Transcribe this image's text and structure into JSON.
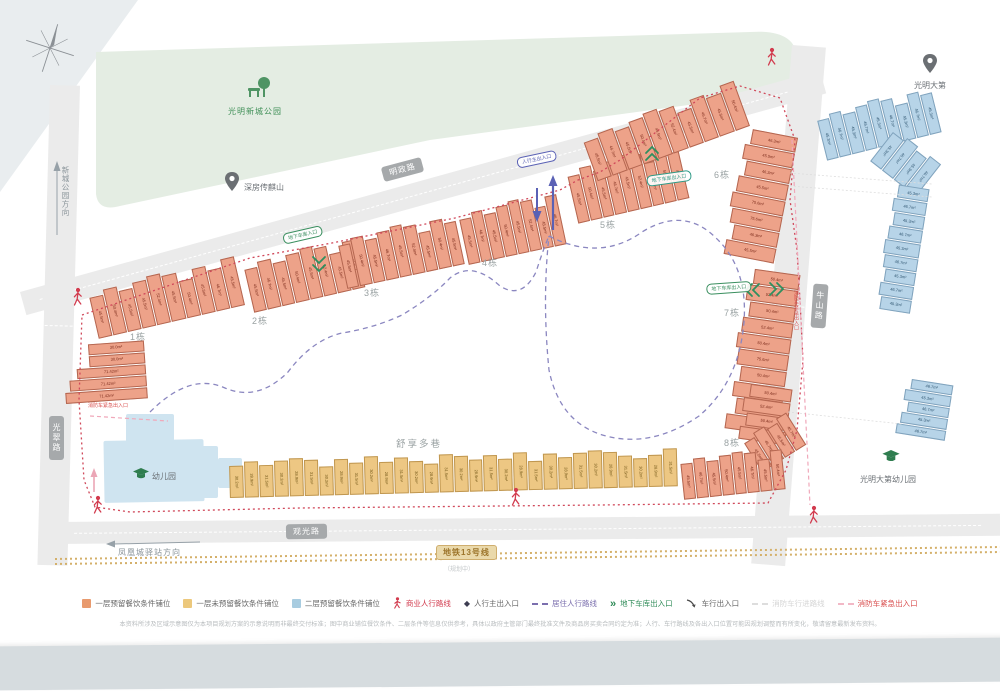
{
  "site_plan": {
    "park": {
      "label": "光明新城公园",
      "icon": "tree-bench-icon",
      "color": "#e4ede3"
    },
    "landmarks": [
      {
        "id": "chuanqishan",
        "label": "深房传麒山",
        "icon": "location-pin-icon"
      },
      {
        "id": "guangmingdadi",
        "label": "光明大第",
        "icon": "location-pin-icon"
      },
      {
        "id": "kindergarten",
        "label": "幼儿园",
        "icon": "graduation-cap-icon"
      },
      {
        "id": "gmdd-kindergarten",
        "label": "光明大第幼儿园",
        "icon": "graduation-cap-icon"
      }
    ],
    "roads": {
      "top": "明政路",
      "bottom": "观光路",
      "left": "光翠路",
      "right": "牛山路"
    },
    "metro": {
      "label": "地铁13号线",
      "note": "（规划中）",
      "color": "#cfae6e"
    },
    "directions": [
      {
        "label": "新城公园方向"
      },
      {
        "label": "凤凰城驿站方向"
      }
    ],
    "entrances": [
      {
        "id": "garage-in-west",
        "label": "地下车库入口",
        "color": "#3a8f5f"
      },
      {
        "id": "pedestrian-main",
        "label": "人行主出入口",
        "color": "#5a61b5"
      },
      {
        "id": "garage-north",
        "label": "地下车库出入口",
        "color": "#2f9a86"
      },
      {
        "id": "garage-east",
        "label": "地下车库出入口",
        "color": "#3a8f5f"
      },
      {
        "id": "fire-west",
        "label": "消防车紧急出入口",
        "color": "#d94f4f"
      },
      {
        "id": "fire-east",
        "label": "消防车紧急出入口",
        "color": "#d94f4f"
      }
    ],
    "area_note": "舒享多巷",
    "building_labels": [
      "1栋",
      "2栋",
      "3栋",
      "4栋",
      "5栋",
      "6栋",
      "7栋",
      "8栋"
    ],
    "clusters": {
      "b1row": {
        "units": [
          "45.5m²",
          "50.4m²",
          "45.5m²",
          "45.5m²",
          "52.4m²",
          "45.5m²",
          "50.4m²",
          "45.5m²",
          "46.7m²",
          "45.5m²"
        ]
      },
      "b1stack": {
        "units": [
          "30.0m²",
          "30.0m²",
          "71.42m²",
          "71.42m²",
          "71.42m²"
        ]
      },
      "b2row": {
        "units": [
          "45.5m²",
          "46.7m²",
          "45.5m²",
          "50.4m²",
          "45.5m²",
          "52.4m²",
          "45.5m²",
          "46.7m²"
        ]
      },
      "b3row": {
        "units": [
          "45.5m²",
          "50.4m²",
          "45.5m²",
          "46.7m²",
          "45.5m²",
          "52.4m²",
          "45.5m²",
          "50.4m²",
          "45.5m²"
        ]
      },
      "b4row": {
        "units": [
          "45.5m²",
          "46.7m²",
          "45.5m²",
          "50.4m²",
          "45.5m²",
          "52.4m²",
          "45.5m²",
          "46.7m²"
        ]
      },
      "b5row": {
        "units": [
          "45.5m²",
          "50.4m²",
          "45.5m²",
          "46.7m²",
          "45.5m²",
          "52.4m²",
          "45.5m²",
          "50.4m²",
          "45.5m²"
        ]
      },
      "b6rowA": {
        "units": [
          "45.5m²",
          "46.7m²",
          "45.5m²",
          "50.4m²",
          "45.5m²",
          "52.4m²",
          "45.5m²",
          "46.7m²",
          "45.5m²",
          "50.4m²"
        ]
      },
      "b6col": {
        "units": [
          "46.3m²",
          "45.5m²",
          "46.3m²",
          "45.5m²",
          "75.6m²",
          "75.6m²",
          "46.3m²",
          "45.5m²"
        ]
      },
      "b7col": {
        "units": [
          "50.4m²",
          "52.4m²",
          "50.4m²",
          "52.4m²",
          "50.4m²",
          "75.6m²",
          "50.4m²",
          "52.4m²",
          "50.4m²",
          "52.4m²"
        ]
      },
      "b8col": {
        "units": [
          "50.4m²",
          "52.4m²",
          "50.4m²",
          "52.4m²"
        ]
      },
      "b8mid": {
        "units": [
          "45.5m²",
          "46.7m²",
          "45.5m²",
          "46.7m²"
        ]
      },
      "b8row": {
        "units": [
          "45.5m²",
          "46.7m²",
          "45.5m²",
          "50.4m²",
          "45.5m²",
          "46.7m²",
          "45.5m²",
          "50.4m²"
        ]
      },
      "yrow": {
        "units": [
          "30.2m²",
          "28.9m²",
          "31.5m²",
          "30.2m²",
          "28.9m²",
          "31.5m²",
          "30.2m²",
          "28.9m²",
          "31.5m²",
          "30.2m²",
          "28.9m²",
          "31.5m²",
          "30.2m²",
          "28.9m²",
          "31.5m²",
          "30.2m²",
          "28.9m²",
          "31.5m²",
          "30.2m²",
          "28.9m²",
          "31.5m²",
          "30.2m²",
          "28.9m²",
          "31.5m²",
          "30.2m²",
          "28.9m²",
          "31.5m²",
          "30.2m²",
          "28.9m²",
          "31.5m²"
        ]
      },
      "blueRowA": {
        "units": [
          "45.3m²",
          "46.7m²",
          "45.3m²",
          "46.7m²",
          "45.3m²",
          "46.7m²",
          "45.3m²",
          "46.7m²",
          "45.3m²"
        ]
      },
      "blueRowB": {
        "units": [
          "45.3m²",
          "46.7m²",
          "45.3m²",
          "46.7m²"
        ]
      },
      "blueColB": {
        "units": [
          "45.3m²",
          "46.7m²",
          "45.3m²",
          "46.7m²",
          "45.3m²",
          "46.7m²",
          "45.3m²",
          "46.7m²",
          "45.3m²"
        ]
      },
      "blueColC": {
        "units": [
          "46.7m²",
          "45.3m²",
          "46.7m²",
          "45.3m²",
          "46.7m²"
        ]
      }
    }
  },
  "legend": {
    "items": [
      {
        "icon": "swatch",
        "color": "#e89a6e",
        "label": "一层预留餐饮条件铺位",
        "label_color": "#666666"
      },
      {
        "icon": "swatch",
        "color": "#ecc87c",
        "label": "一层未预留餐饮条件铺位",
        "label_color": "#666666"
      },
      {
        "icon": "swatch",
        "color": "#a8cce0",
        "label": "二层预留餐饮条件铺位",
        "label_color": "#666666"
      },
      {
        "icon": "walking-person",
        "color": "#d23b4e",
        "label": "商业人行路线",
        "label_color": "#d23b4e"
      },
      {
        "icon": "diamond",
        "color": "#3d3d52",
        "label": "人行主出入口",
        "label_color": "#666666"
      },
      {
        "icon": "dash",
        "color": "#7b6fae",
        "label": "居住人行路线",
        "label_color": "#7b6fae"
      },
      {
        "icon": "double-chevron",
        "color": "#2e8b57",
        "label": "地下车库出入口",
        "label_color": "#2e8b57"
      },
      {
        "icon": "curved-arrow",
        "color": "#4a4a4a",
        "label": "车行出入口",
        "label_color": "#666666"
      },
      {
        "icon": "dash",
        "color": "#dddddd",
        "label": "消防车行进路线",
        "label_color": "#d5d5d5"
      },
      {
        "icon": "dash",
        "color": "#f2b8c6",
        "label": "消防车紧急出入口",
        "label_color": "#d94f4f"
      }
    ]
  },
  "disclaimer": "本资料所涉及区域示意图仅为本项目规划方案的示意说明而非最终交付标准；图中商业铺位餐饮条件、二层条件等信息仅供参考，具体以政府主管部门最终批准文件及商品房买卖合同约定为准；人行、车行路线及各出入口位置可能因规划调整而有所变化，敬请留意最新发布资料。"
}
